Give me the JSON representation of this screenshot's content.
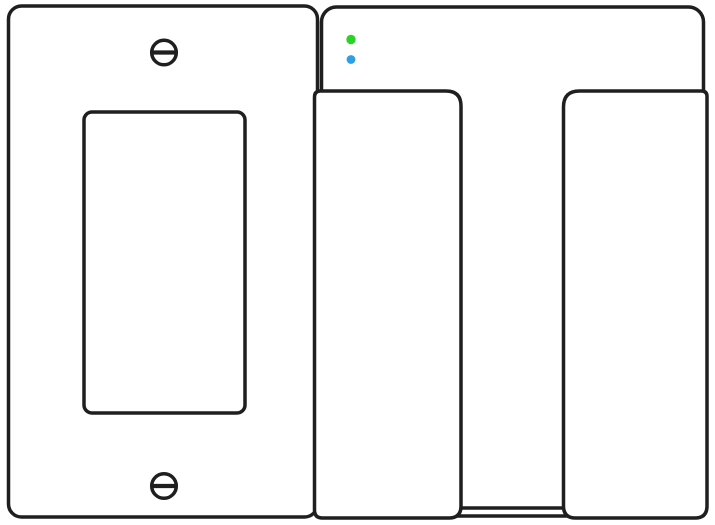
{
  "diagram": {
    "description_name": "wall-switch-installation-line-drawing",
    "background": "#ffffff",
    "line_color": "#1f1f1f",
    "line_width": 3.5,
    "wall_plate": {
      "fill": "#ffffff",
      "screws": [
        "slotted-screw-top",
        "slotted-screw-bottom"
      ],
      "opening": "rocker-switch-opening"
    },
    "smart_switch": {
      "body_fill": "#ffffff",
      "leds": [
        {
          "name": "green-status-led",
          "color": "#2bd327"
        },
        {
          "name": "blue-status-led",
          "color": "#2d9fe8"
        }
      ],
      "paddles": [
        "left-paddle",
        "right-paddle"
      ]
    }
  }
}
